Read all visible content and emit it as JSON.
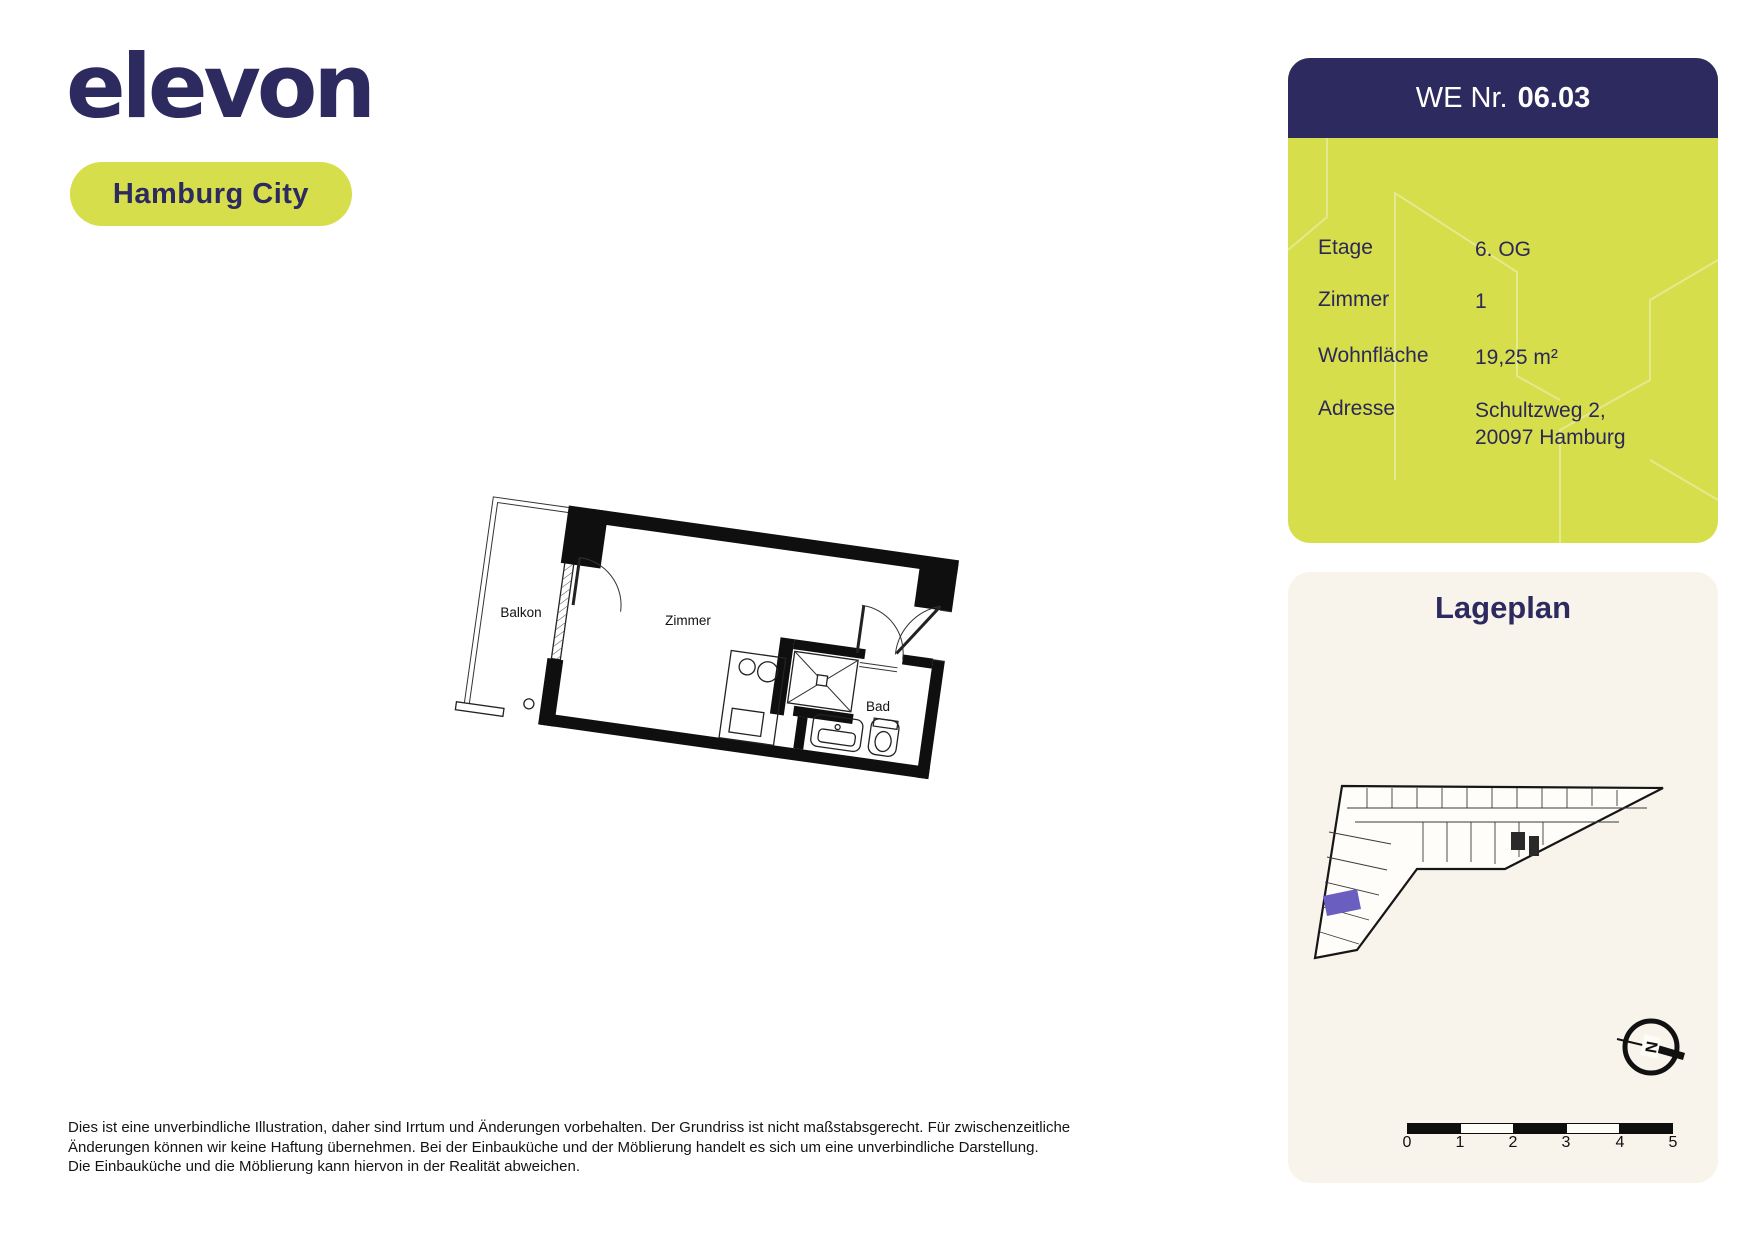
{
  "brand": {
    "logo_text": "elevon",
    "location_label": "Hamburg City"
  },
  "unit_card": {
    "title_prefix": "WE Nr.",
    "title_number": "06.03",
    "rows": [
      {
        "label": "Etage",
        "value": "6. OG"
      },
      {
        "label": "Zimmer",
        "value": "1"
      },
      {
        "label": "Wohnfläche",
        "value": "19,25 m²"
      },
      {
        "label": "Adresse",
        "value": "Schultzweg 2,",
        "value_line2": "20097 Hamburg"
      }
    ]
  },
  "floorplan": {
    "labels": {
      "balcony": "Balkon",
      "room": "Zimmer",
      "bath": "Bad"
    }
  },
  "siteplan": {
    "title": "Lageplan",
    "compass_letter": "N",
    "scale_ticks": [
      "0",
      "1",
      "2",
      "3",
      "4",
      "5"
    ]
  },
  "disclaimer": {
    "lines": [
      "Dies ist eine unverbindliche Illustration, daher sind Irrtum und Änderungen vorbehalten. Der Grundriss ist nicht maßstabsgerecht. Für zwischenzeitliche",
      "Änderungen können wir keine Haftung übernehmen. Bei der Einbauküche und der Möblierung handelt es sich um eine unverbindliche Darstellung.",
      "Die Einbauküche und die Möblierung kann hiervon in der Realität abweichen."
    ]
  },
  "colors": {
    "navy": "#2d2a5f",
    "lime": "#d6de4b",
    "cream": "#f8f4ec",
    "highlight_purple": "#6a5fc1",
    "wall_black": "#0f0f0f"
  }
}
